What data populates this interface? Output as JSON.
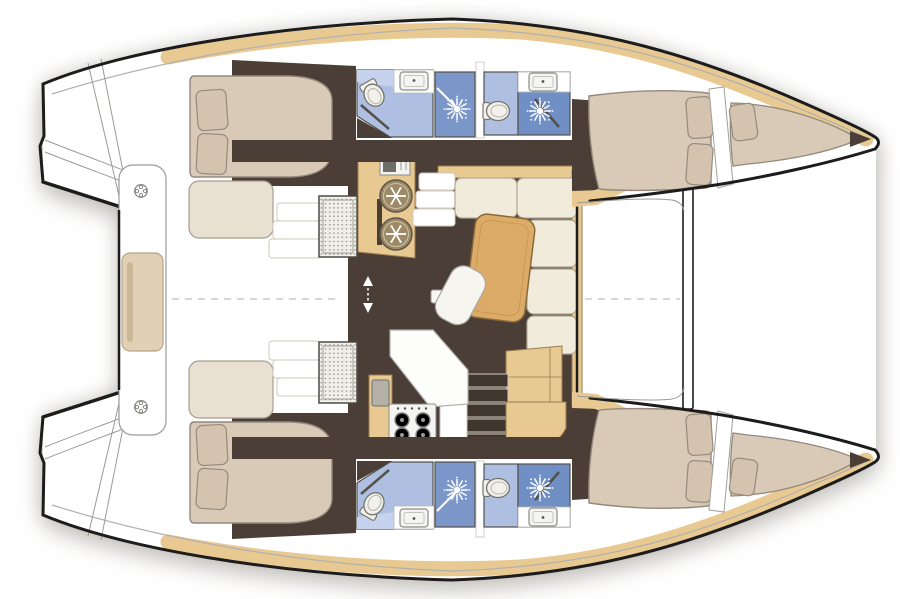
{
  "palette": {
    "ink": "#1c1c1c",
    "sheer": "#b0b0b0",
    "seam": "#9a9a96",
    "wall": "#55504a",
    "floor": "#4b3e36",
    "floorDark": "#40362e",
    "wood": "#e8c992",
    "woodEdge": "#9a7b4f",
    "tableWood": "#dcab67",
    "tableEdge": "#8a6a3a",
    "bed": "#d9c9b7",
    "bedEdge": "#93897c",
    "pillow": "#d4c3ae",
    "pillowEdge": "#958b7d",
    "cream": "#f1ebdc",
    "creamEdge": "#b3ab99",
    "berth": "#eae0d2",
    "berthEdge": "#a79d8e",
    "bath": "#aebfe2",
    "bathLight": "#c7d3ee",
    "shower": "#7b97c9",
    "showerDeep": "#7090c5",
    "wcFill": "#f2f0ea",
    "wcEdge": "#75756f",
    "fixture": "#f4f4f2",
    "fixtureEdge": "#8a8a86",
    "sinkGray": "#b5b1a9",
    "bench": "#e2d0b6",
    "benchEdge": "#b7a487",
    "benchSlot": "#cbb795",
    "grate": "#f1efe9",
    "grateDot": "#9b978c",
    "stepDark": "#40362e",
    "stepEdge": "#cfc9bd",
    "dash": "#c0c0bc",
    "white": "#ffffff"
  },
  "vessel": {
    "kind": "catamaran-interior-floor-plan",
    "orientation": {
      "bow": "right",
      "stern": "left"
    },
    "symmetry": "two hulls mirrored about horizontal centerline",
    "hulls": [
      {
        "name": "port-hull",
        "position": "top",
        "rooms": [
          {
            "name": "aft-cabin",
            "fixtures": [
              "double-berth",
              "pillow",
              "pillow",
              "side-berth",
              "access-steps",
              "hatch-grate"
            ]
          },
          {
            "name": "aft-head",
            "fixtures": [
              "toilet",
              "washbasin",
              "shower-stall",
              "shower-head",
              "door"
            ]
          },
          {
            "name": "forward-head",
            "fixtures": [
              "toilet",
              "washbasin",
              "shower-stall",
              "shower-head",
              "door"
            ]
          },
          {
            "name": "forward-cabin",
            "fixtures": [
              "double-berth",
              "pillow",
              "pillow",
              "bulkhead"
            ]
          },
          {
            "name": "forepeak-berth",
            "fixtures": [
              "berth",
              "pillow",
              "anchor-locker"
            ]
          }
        ]
      },
      {
        "name": "starboard-hull",
        "position": "bottom",
        "rooms": [
          {
            "name": "aft-cabin",
            "fixtures": [
              "double-berth",
              "pillow",
              "pillow",
              "side-berth",
              "access-steps",
              "hatch-grate"
            ]
          },
          {
            "name": "aft-head",
            "fixtures": [
              "toilet",
              "washbasin",
              "shower-stall",
              "shower-head",
              "door"
            ]
          },
          {
            "name": "forward-head",
            "fixtures": [
              "toilet",
              "washbasin",
              "shower-stall",
              "shower-head",
              "door"
            ]
          },
          {
            "name": "forward-cabin",
            "fixtures": [
              "double-berth",
              "pillow",
              "pillow",
              "bulkhead"
            ]
          },
          {
            "name": "forepeak-berth",
            "fixtures": [
              "berth",
              "pillow",
              "anchor-locker"
            ]
          }
        ]
      }
    ],
    "saloon": {
      "fixtures": [
        "galley-counter",
        "refrigerator",
        "refrigerator",
        "appliance",
        "l-shaped-sofa",
        "dining-table",
        "stool",
        "nav-desk",
        "island-counter",
        "galley-sink",
        "stove-4-burner",
        "companionway-steps-port",
        "companionway-steps-starboard",
        "floor-hatch",
        "direction-arrows"
      ]
    },
    "cockpit": {
      "fixtures": [
        "aft-bench",
        "bench-cushion",
        "deck-ring",
        "deck-ring",
        "transom-steps"
      ]
    },
    "deck": {
      "fixtures": [
        "forward-crossbeam",
        "centerline-dashes"
      ]
    }
  }
}
